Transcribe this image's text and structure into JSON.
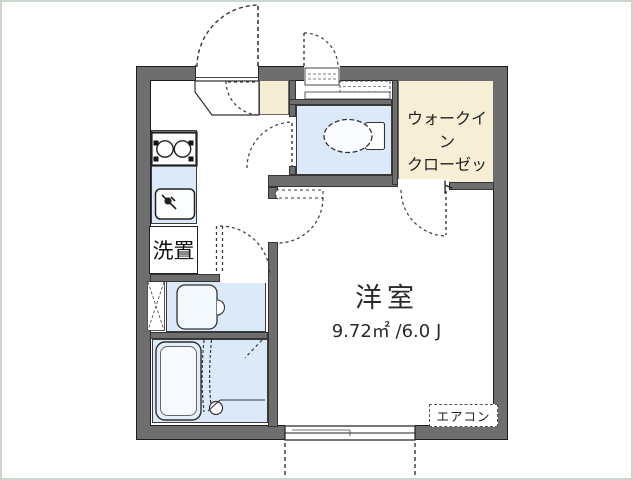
{
  "floorplan": {
    "rooms": {
      "closet_line1": "ウォークイン",
      "closet_line2": "クローゼット",
      "main_room": "洋室",
      "main_room_area": "9.72㎡ /6.0 J"
    },
    "fixtures": {
      "washer_space": "洗置",
      "aircon": "エアコン"
    },
    "colors": {
      "wall_gray": "#6e6e6e",
      "water_area_blue": "#dce9f8",
      "closet_cream": "#f7eed6",
      "frame_border": "#ccd6cc"
    },
    "icons": {
      "toilet-icon": "dashed ellipse bowl with tank",
      "bathtub-icon": "double rounded rectangle",
      "stove-icon": "two burner circles",
      "sink-faucet-icon": "dot with spout lines",
      "washbasin-icon": "rounded square with side knob",
      "door-swing-icon": "dashed quarter arc",
      "sliding-window-icon": "triple line in wall"
    }
  }
}
